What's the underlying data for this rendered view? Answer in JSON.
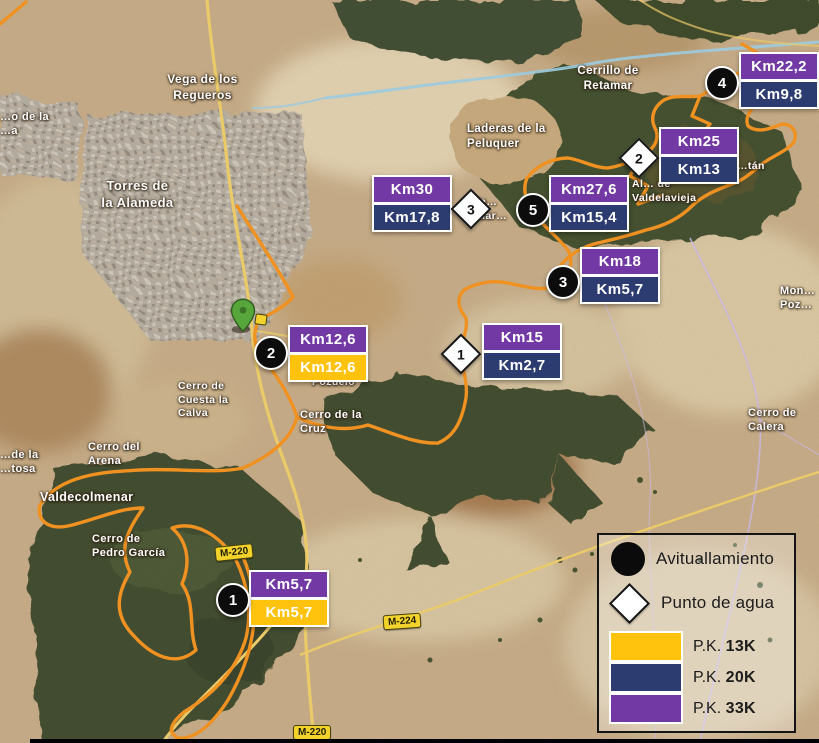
{
  "colors": {
    "pk13": "#FFC20D",
    "pk20": "#2C3C70",
    "pk33": "#7239A4",
    "route": "#F7941E",
    "aid": "#0C0C0C",
    "water": "#FFFFFF"
  },
  "legend": {
    "aid_label": "Avituallamiento",
    "water_label": "Punto de agua",
    "pk": [
      {
        "prefix": "P.K.",
        "value": "13K",
        "key": "pk13"
      },
      {
        "prefix": "P.K.",
        "value": "20K",
        "key": "pk20"
      },
      {
        "prefix": "P.K.",
        "value": "33K",
        "key": "pk33"
      }
    ]
  },
  "markers": [
    {
      "kind": "aid",
      "number": "4",
      "chips": [
        {
          "text": "Km22,2",
          "pk": "pk33"
        },
        {
          "text": "Km9,8",
          "pk": "pk20"
        }
      ]
    },
    {
      "kind": "water",
      "number": "2",
      "chips": [
        {
          "text": "Km25",
          "pk": "pk33"
        },
        {
          "text": "Km13",
          "pk": "pk20"
        }
      ]
    },
    {
      "kind": "water",
      "number": "3",
      "chips": [
        {
          "text": "Km30",
          "pk": "pk33"
        },
        {
          "text": "Km17,8",
          "pk": "pk20"
        }
      ]
    },
    {
      "kind": "aid",
      "number": "5",
      "chips": [
        {
          "text": "Km27,6",
          "pk": "pk33"
        },
        {
          "text": "Km15,4",
          "pk": "pk20"
        }
      ]
    },
    {
      "kind": "aid",
      "number": "3",
      "chips": [
        {
          "text": "Km18",
          "pk": "pk33"
        },
        {
          "text": "Km5,7",
          "pk": "pk20"
        }
      ]
    },
    {
      "kind": "water",
      "number": "1",
      "chips": [
        {
          "text": "Km15",
          "pk": "pk33"
        },
        {
          "text": "Km2,7",
          "pk": "pk20"
        }
      ]
    },
    {
      "kind": "aid",
      "number": "2",
      "chips": [
        {
          "text": "Km12,6",
          "pk": "pk33"
        },
        {
          "text": "Km12,6",
          "pk": "pk13"
        }
      ]
    },
    {
      "kind": "aid",
      "number": "1",
      "chips": [
        {
          "text": "Km5,7",
          "pk": "pk33"
        },
        {
          "text": "Km5,7",
          "pk": "pk13"
        }
      ]
    }
  ],
  "map_labels": [
    {
      "text": "Vega de los\nRegueros"
    },
    {
      "text": "Torres de\nla Alameda"
    },
    {
      "text": "Cerrillo de\nRetamar"
    },
    {
      "text": "Laderas de la\nPeluquer"
    },
    {
      "text": "Lla…\nGuar…"
    },
    {
      "text": "…tán"
    },
    {
      "text": "Al… de\nValdelavieja"
    },
    {
      "text": "Mon…\nPoz…"
    },
    {
      "text": "Cerro de\nCalera"
    },
    {
      "text": "Cerro de\nCuesta la\nCalva"
    },
    {
      "text": "Pozuelo"
    },
    {
      "text": "Cerro de la\nCruz"
    },
    {
      "text": "Cerro del\nArena"
    },
    {
      "text": "Valdecolmenar"
    },
    {
      "text": "Cerro de\nPedro García"
    },
    {
      "text": "…o de la\n…a"
    },
    {
      "text": "…de la\n…tosa"
    }
  ],
  "road_shields": [
    {
      "text": "M-220"
    },
    {
      "text": "M-224"
    },
    {
      "text": "M-220"
    }
  ]
}
